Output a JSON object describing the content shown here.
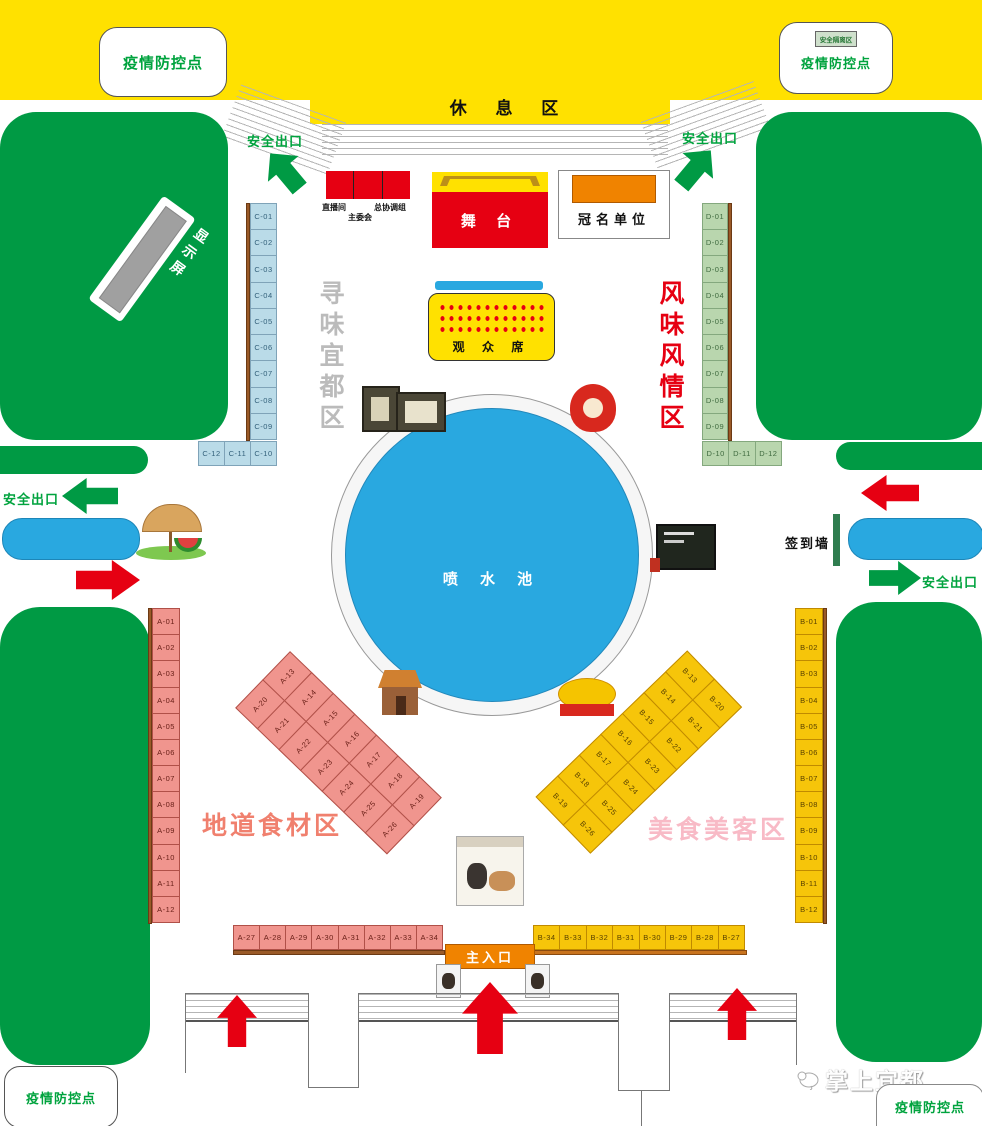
{
  "top": {
    "rest_area": "休 息 区",
    "covid_left": "疫情防控点",
    "covid_right": "疫情防控点",
    "isolation": "安全隔离区"
  },
  "exits": {
    "label": "安全出口"
  },
  "stage": {
    "live_room": "直播间",
    "committee": "主委会",
    "coordination": "总协调组",
    "stage_label": "舞 台",
    "sponsor": "冠名单位"
  },
  "screen_label": "显示屏",
  "audience_label": "观 众 席",
  "fountain_label": "喷 水 池",
  "signin_wall": "签到墙",
  "entrance_label": "主入口",
  "zones": {
    "xunwei": "寻味宜都区",
    "fengwei": "风味风情区",
    "didao": "地道食材区",
    "meishi": "美食美客区"
  },
  "bottom": {
    "covid_left": "疫情防控点",
    "covid_right": "疫情防控点",
    "watermark": "掌上宜都"
  },
  "stalls": {
    "c_column": [
      "C-01",
      "C-02",
      "C-03",
      "C-04",
      "C-05",
      "C-06",
      "C-07",
      "C-08",
      "C-09"
    ],
    "c_row": [
      "C-12",
      "C-11",
      "C-10"
    ],
    "d_column": [
      "D-01",
      "D-02",
      "D-03",
      "D-04",
      "D-05",
      "D-06",
      "D-07",
      "D-08",
      "D-09"
    ],
    "d_row": [
      "D-10",
      "D-11",
      "D-12"
    ],
    "a_column": [
      "A-01",
      "A-02",
      "A-03",
      "A-04",
      "A-05",
      "A-06",
      "A-07",
      "A-08",
      "A-09",
      "A-10",
      "A-11",
      "A-12"
    ],
    "a_diag_left": [
      "A-20",
      "A-21",
      "A-22",
      "A-23",
      "A-24",
      "A-25",
      "A-26"
    ],
    "a_diag_right": [
      "A-13",
      "A-14",
      "A-15",
      "A-16",
      "A-17",
      "A-18",
      "A-19"
    ],
    "a_row": [
      "A-27",
      "A-28",
      "A-29",
      "A-30",
      "A-31",
      "A-32",
      "A-33",
      "A-34"
    ],
    "b_column": [
      "B-01",
      "B-02",
      "B-03",
      "B-04",
      "B-05",
      "B-06",
      "B-07",
      "B-08",
      "B-09",
      "B-10",
      "B-11",
      "B-12"
    ],
    "b_diag_left": [
      "B-13",
      "B-14",
      "B-15",
      "B-16",
      "B-17",
      "B-18",
      "B-19"
    ],
    "b_diag_right": [
      "B-20",
      "B-21",
      "B-22",
      "B-23",
      "B-24",
      "B-25",
      "B-26"
    ],
    "b_row": [
      "B-34",
      "B-33",
      "B-32",
      "B-31",
      "B-30",
      "B-29",
      "B-28",
      "B-27"
    ]
  },
  "colors": {
    "green": "#009a44",
    "yellow": "#ffe100",
    "red": "#e60012",
    "orange": "#f08300",
    "blue": "#29a8e0",
    "stall_pink": "#f0958e",
    "stall_yellow": "#f6c50a",
    "stall_blue": "#badbe8",
    "stall_green": "#b9d6ae"
  }
}
